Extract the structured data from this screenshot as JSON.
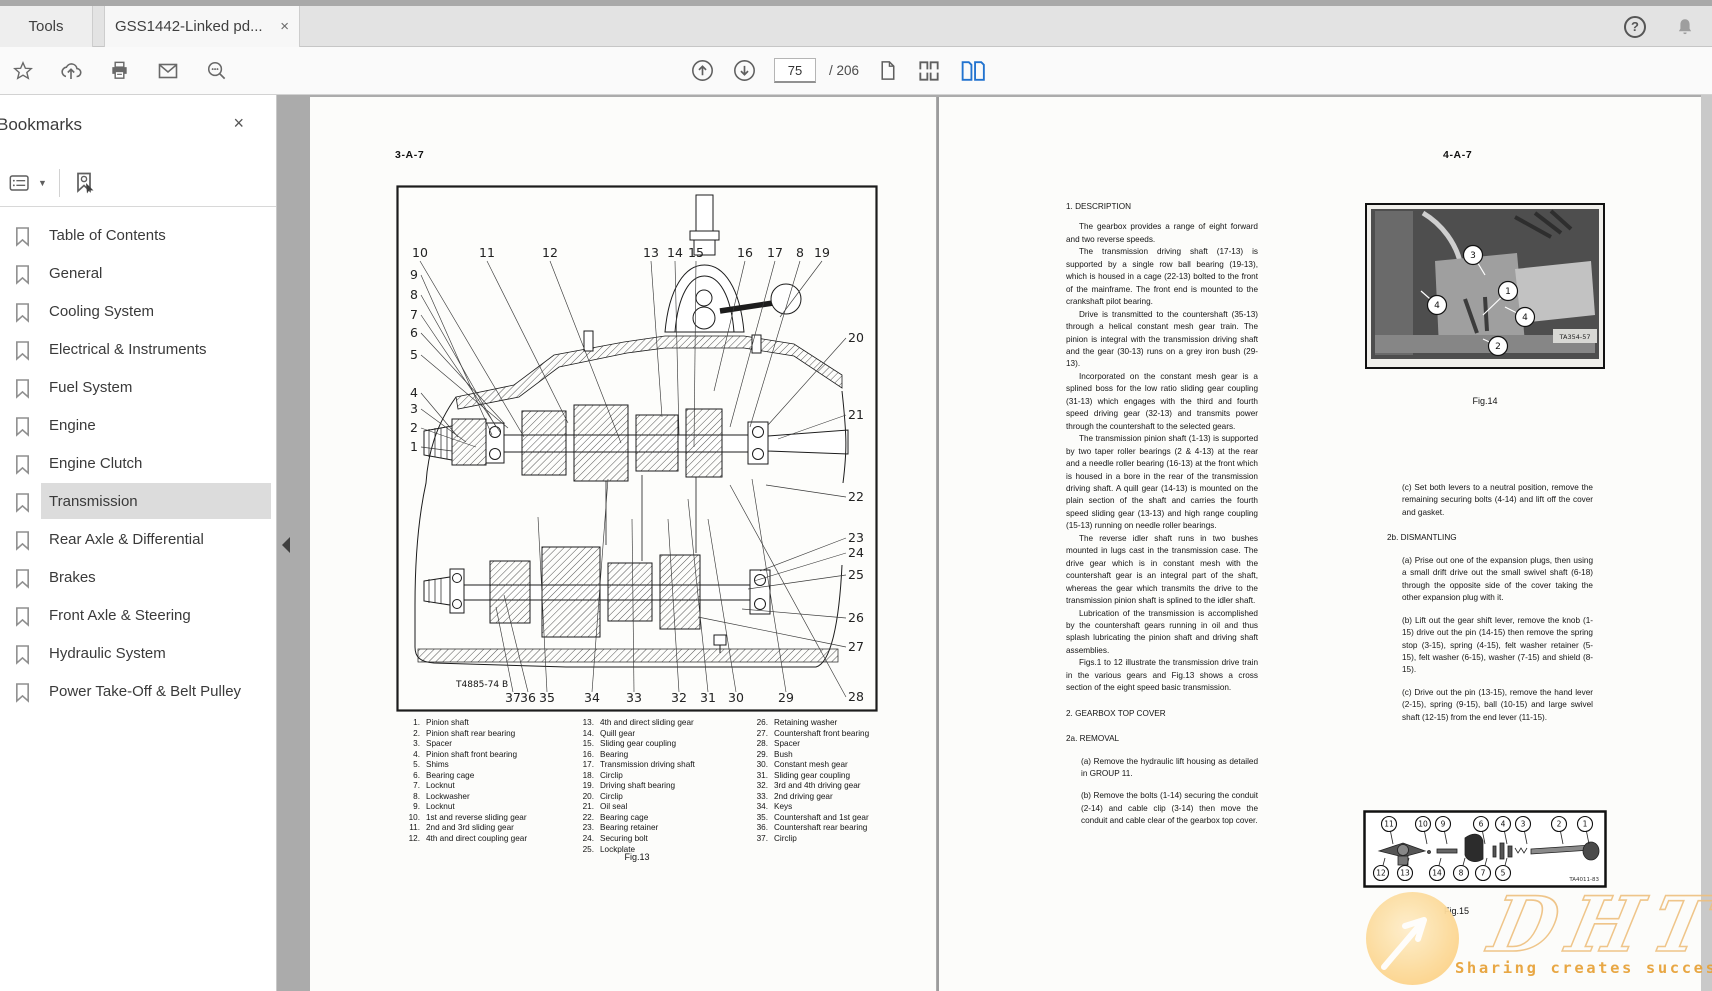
{
  "window": {
    "tab_tools": "Tools",
    "tab_document": "GSS1442-Linked pd...",
    "close_glyph": "×",
    "help_glyph": "?"
  },
  "toolbar": {
    "page_current": "75",
    "page_total_label": "/ 206"
  },
  "bookmarks_panel": {
    "title": "Bookmarks",
    "selected_item": "Transmission",
    "items": [
      "Table of Contents",
      "General",
      "Cooling System",
      "Electrical & Instruments",
      "Fuel System",
      "Engine",
      "Engine Clutch",
      "Transmission",
      "Rear Axle & Differential",
      "Brakes",
      "Front Axle & Steering",
      "Hydraulic System",
      "Power Take-Off & Belt Pulley"
    ]
  },
  "left_page": {
    "page_ref": "3-A-7",
    "figure": {
      "caption": "Fig.13",
      "drawing_ref": "T4885-74 B",
      "callouts_top": [
        "10",
        "11",
        "12",
        "13",
        "14",
        "15",
        "16",
        "17",
        "8",
        "19"
      ],
      "callouts_left": [
        "9",
        "8",
        "7",
        "6",
        "5",
        "4",
        "3",
        "2",
        "1"
      ],
      "callouts_right": [
        "20",
        "21",
        "22",
        "23",
        "24",
        "25",
        "26",
        "27",
        "28"
      ],
      "callouts_bottom": [
        "37",
        "36",
        "35",
        "34",
        "33",
        "32",
        "31",
        "30",
        "29"
      ]
    },
    "parts_col1": [
      {
        "num": "1.",
        "name": "Pinion shaft"
      },
      {
        "num": "2.",
        "name": "Pinion shaft rear bearing"
      },
      {
        "num": "3.",
        "name": "Spacer"
      },
      {
        "num": "4.",
        "name": "Pinion shaft front bearing"
      },
      {
        "num": "5.",
        "name": "Shims"
      },
      {
        "num": "6.",
        "name": "Bearing cage"
      },
      {
        "num": "7.",
        "name": "Locknut"
      },
      {
        "num": "8.",
        "name": "Lockwasher"
      },
      {
        "num": "9.",
        "name": "Locknut"
      },
      {
        "num": "10.",
        "name": "1st and reverse sliding gear"
      },
      {
        "num": "11.",
        "name": "2nd and 3rd sliding gear"
      },
      {
        "num": "12.",
        "name": "4th and direct coupling gear"
      }
    ],
    "parts_col2": [
      {
        "num": "13.",
        "name": "4th and direct sliding gear"
      },
      {
        "num": "14.",
        "name": "Quill gear"
      },
      {
        "num": "15.",
        "name": "Sliding gear coupling"
      },
      {
        "num": "16.",
        "name": "Bearing"
      },
      {
        "num": "17.",
        "name": "Transmission driving shaft"
      },
      {
        "num": "18.",
        "name": "Circlip"
      },
      {
        "num": "19.",
        "name": "Driving shaft bearing"
      },
      {
        "num": "20.",
        "name": "Circlip"
      },
      {
        "num": "21.",
        "name": "Oil seal"
      },
      {
        "num": "22.",
        "name": "Bearing cage"
      },
      {
        "num": "23.",
        "name": "Bearing retainer"
      },
      {
        "num": "24.",
        "name": "Securing bolt"
      },
      {
        "num": "25.",
        "name": "Lockplate"
      }
    ],
    "parts_col3": [
      {
        "num": "26.",
        "name": "Retaining washer"
      },
      {
        "num": "27.",
        "name": "Countershaft front bearing"
      },
      {
        "num": "28.",
        "name": "Spacer"
      },
      {
        "num": "29.",
        "name": "Bush"
      },
      {
        "num": "30.",
        "name": "Constant mesh gear"
      },
      {
        "num": "31.",
        "name": "Sliding gear coupling"
      },
      {
        "num": "32.",
        "name": "3rd and 4th driving gear"
      },
      {
        "num": "33.",
        "name": "2nd driving gear"
      },
      {
        "num": "34.",
        "name": "Keys"
      },
      {
        "num": "35.",
        "name": "Countershaft and 1st gear"
      },
      {
        "num": "36.",
        "name": "Countershaft rear bearing"
      },
      {
        "num": "37.",
        "name": "Circlip"
      }
    ]
  },
  "right_page": {
    "page_ref": "4-A-7",
    "column1_sections": [
      {
        "type": "heading",
        "text": "1. DESCRIPTION"
      },
      {
        "type": "para",
        "text": "The gearbox provides a range of eight forward and two reverse speeds."
      },
      {
        "type": "para",
        "text": "The transmission driving shaft (17-13) is supported by a single row ball bearing (19-13), which is housed in a cage (22-13) bolted to the front of the mainframe. The front end is mounted to the crankshaft pilot bearing."
      },
      {
        "type": "para",
        "text": "Drive is transmitted to the countershaft (35-13) through a helical constant mesh gear train. The pinion is integral with the transmission driving shaft and the gear (30-13) runs on a grey iron bush (29-13)."
      },
      {
        "type": "para",
        "text": "Incorporated on the constant mesh gear is a splined boss for the low ratio sliding gear coupling (31-13) which engages with the third and fourth speed driving gear (32-13) and transmits power through the countershaft to the selected gears."
      },
      {
        "type": "para",
        "text": "The transmission pinion shaft (1-13) is supported by two taper roller bearings (2 & 4-13) at the rear and a needle roller bearing (16-13) at the front which is housed in a bore in the rear of the transmission driving shaft. A quill gear (14-13) is mounted on the plain section of the shaft and carries the fourth speed sliding gear (13-13) and high range coupling (15-13) running on needle roller bearings."
      },
      {
        "type": "para",
        "text": "The reverse idler shaft runs in two bushes mounted in lugs cast in the transmission case. The drive gear which is in constant mesh with the countershaft gear is an integral part of the shaft, whereas the gear which transmits the drive to the transmission pinion shaft is splined to the idler shaft."
      },
      {
        "type": "para",
        "text": "Lubrication of the transmission is accomplished by the countershaft gears running in oil and thus splash lubricating the pinion shaft and driving shaft assemblies."
      },
      {
        "type": "para",
        "text": "Figs.1 to 12 illustrate the transmission drive train in the various gears and Fig.13 shows a cross section of the eight speed basic transmission."
      },
      {
        "type": "heading",
        "text": "2. GEARBOX TOP COVER"
      },
      {
        "type": "heading",
        "text": "2a. REMOVAL"
      },
      {
        "type": "step",
        "text": "(a) Remove the hydraulic lift housing as detailed in GROUP 11."
      },
      {
        "type": "step",
        "text": "(b) Remove the bolts (1-14) securing the conduit (2-14) and cable clip (3-14) then move the conduit and cable clear of the gearbox top cover."
      }
    ],
    "column2_sections": [
      {
        "type": "step",
        "text": "(c) Set both levers to a neutral position, remove the remaining securing bolts (4-14) and lift off the cover and gasket."
      },
      {
        "type": "heading",
        "text": "2b. DISMANTLING"
      },
      {
        "type": "step",
        "text": "(a) Prise out one of the expansion plugs, then using a small drift drive out the small swivel shaft (6-18) through the opposite side of the cover taking the other expansion plug with it."
      },
      {
        "type": "step",
        "text": "(b) Lift out the gear shift lever, remove the knob (1-15) drive out the pin (14-15) then remove the spring stop (3-15), spring (4-15), felt washer retainer (5-15), felt washer (6-15), washer (7-15) and shield (8-15)."
      },
      {
        "type": "step",
        "text": "(c) Drive out the pin (13-15), remove the hand lever (2-15), spring (9-15), ball (10-15) and large swivel shaft (12-15) from the end lever (11-15)."
      }
    ],
    "fig14": {
      "caption": "Fig.14",
      "photo_ref": "TA354-57",
      "callouts": [
        "3",
        "1",
        "4",
        "4",
        "2"
      ]
    },
    "fig15": {
      "caption": "Fig.15",
      "photo_ref": "TA4011-83",
      "callouts_top": [
        "11",
        "10",
        "9",
        "6",
        "4",
        "3",
        "2",
        "1"
      ],
      "callouts_bottom": [
        "12",
        "13",
        "14",
        "8",
        "7",
        "5"
      ]
    }
  },
  "watermark": {
    "brand": "DHT",
    "slogan": "Sharing creates success"
  }
}
